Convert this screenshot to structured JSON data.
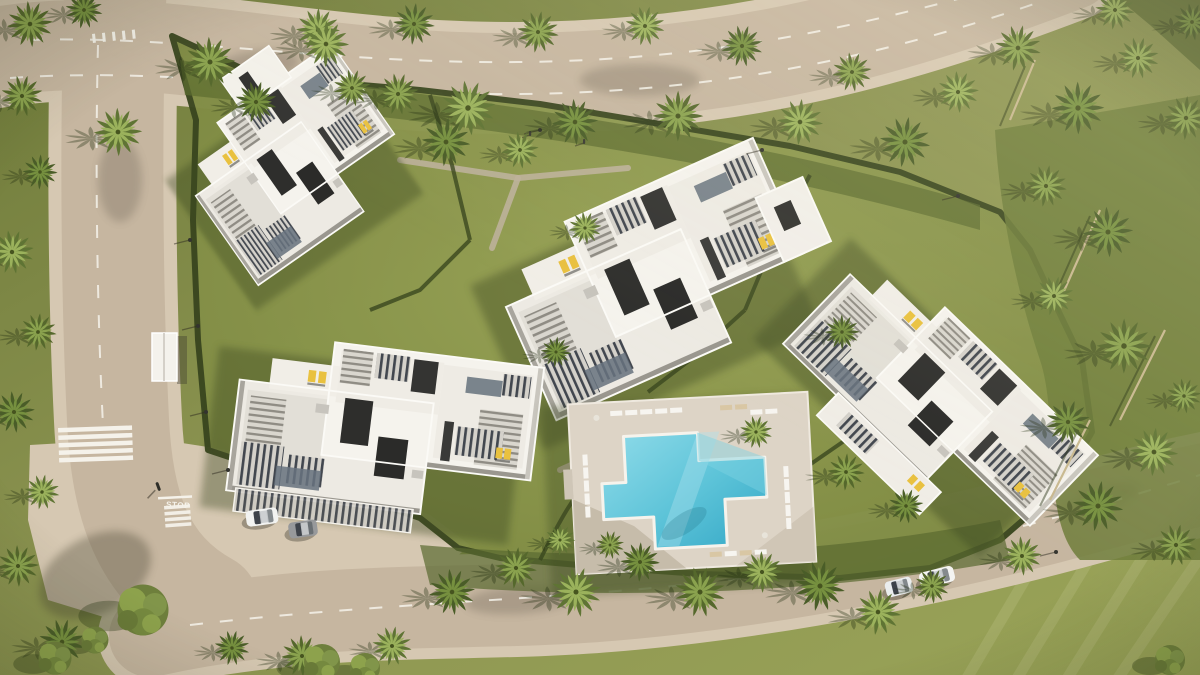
{
  "scene": {
    "description": "Aerial top-down 3D render of a white modern apartment complex: five building clusters with rooftop terraces and pergolas, central lawns, cross-shaped swimming pool with sun loungers, perimeter roads with lane markings, crosswalks, parked cars, street lamps and dense palm trees",
    "road_markings": {
      "stop_label": "STOP"
    },
    "colors": {
      "grass": "#8b9350",
      "grassDark": "#5f6c33",
      "hedge": "#3a471f",
      "road": "#c6b6a0",
      "sidewalk": "#d6c8b2",
      "marking": "#f5f2ea",
      "building": "#f2efe9",
      "deck": "#ddd4c6",
      "poolWater": "#35a8c6",
      "poolWaterLight": "#8fdbe9",
      "lounger": "#e9c13f"
    },
    "palm_variants": [
      {
        "under": "#55682c",
        "over": "#8aa24e"
      },
      {
        "under": "#4a5d28",
        "over": "#76903f"
      },
      {
        "under": "#5f7434",
        "over": "#9bb25c"
      }
    ],
    "palms": [
      [
        210,
        62,
        1.15
      ],
      [
        256,
        102,
        0.95
      ],
      [
        318,
        30,
        1.0
      ],
      [
        352,
        88,
        0.85
      ],
      [
        414,
        24,
        0.95
      ],
      [
        468,
        108,
        1.25
      ],
      [
        538,
        32,
        0.95
      ],
      [
        575,
        122,
        1.05
      ],
      [
        645,
        26,
        0.9
      ],
      [
        678,
        116,
        1.15
      ],
      [
        742,
        46,
        0.95
      ],
      [
        800,
        122,
        1.05
      ],
      [
        852,
        72,
        0.9
      ],
      [
        905,
        142,
        1.15
      ],
      [
        958,
        92,
        0.95
      ],
      [
        1018,
        48,
        1.05
      ],
      [
        1078,
        108,
        1.2
      ],
      [
        1138,
        58,
        0.95
      ],
      [
        1186,
        118,
        1.0
      ],
      [
        1192,
        22,
        0.85
      ],
      [
        1115,
        10,
        0.9
      ],
      [
        30,
        24,
        1.05
      ],
      [
        84,
        10,
        0.85
      ],
      [
        118,
        132,
        1.1
      ],
      [
        22,
        96,
        0.95
      ],
      [
        40,
        172,
        0.8
      ],
      [
        12,
        252,
        1.0
      ],
      [
        38,
        332,
        0.85
      ],
      [
        14,
        412,
        0.95
      ],
      [
        42,
        492,
        0.8
      ],
      [
        18,
        566,
        0.95
      ],
      [
        62,
        642,
        1.05
      ],
      [
        326,
        44,
        1.05
      ],
      [
        398,
        94,
        0.95
      ],
      [
        446,
        142,
        1.1
      ],
      [
        520,
        150,
        0.85
      ],
      [
        1046,
        186,
        0.95
      ],
      [
        1108,
        232,
        1.15
      ],
      [
        1054,
        296,
        0.9
      ],
      [
        1124,
        346,
        1.25
      ],
      [
        1068,
        422,
        1.0
      ],
      [
        1154,
        452,
        1.1
      ],
      [
        1184,
        396,
        0.8
      ],
      [
        1098,
        506,
        1.15
      ],
      [
        1022,
        556,
        0.9
      ],
      [
        1176,
        545,
        0.95
      ],
      [
        842,
        332,
        0.8
      ],
      [
        756,
        432,
        0.75
      ],
      [
        846,
        472,
        0.85
      ],
      [
        906,
        506,
        0.8
      ],
      [
        878,
        612,
        1.05
      ],
      [
        932,
        586,
        0.8
      ],
      [
        820,
        586,
        1.15
      ],
      [
        762,
        572,
        0.95
      ],
      [
        700,
        592,
        1.15
      ],
      [
        640,
        562,
        0.9
      ],
      [
        576,
        592,
        1.15
      ],
      [
        516,
        568,
        0.95
      ],
      [
        452,
        592,
        1.05
      ],
      [
        392,
        646,
        0.9
      ],
      [
        302,
        656,
        0.95
      ],
      [
        232,
        648,
        0.8
      ],
      [
        560,
        540,
        0.7
      ],
      [
        610,
        545,
        0.65
      ],
      [
        556,
        352,
        0.7
      ],
      [
        585,
        228,
        0.75
      ]
    ],
    "trees": [
      [
        143,
        610,
        1.7
      ],
      [
        322,
        662,
        1.2
      ],
      [
        55,
        658,
        1.1
      ],
      [
        95,
        640,
        0.9
      ],
      [
        365,
        668,
        1.0
      ],
      [
        1170,
        660,
        1.0
      ]
    ],
    "trunks": [
      [
        1060,
        300,
        1100,
        210
      ],
      [
        1120,
        420,
        1165,
        330
      ],
      [
        1050,
        500,
        1090,
        420
      ],
      [
        1010,
        120,
        1035,
        60
      ]
    ],
    "cars": [
      {
        "x": 262,
        "y": 517,
        "r": -8,
        "c": "#f2f3f1",
        "t": 1
      },
      {
        "x": 303,
        "y": 529,
        "r": -8,
        "c": "#97999b",
        "t": 0.9
      },
      {
        "x": 899,
        "y": 587,
        "r": -14,
        "c": "#eaedee",
        "t": 0.85
      },
      {
        "x": 937,
        "y": 577,
        "r": -14,
        "c": "#f4f4f2",
        "t": 1.1
      }
    ],
    "lamps": [
      [
        190,
        240
      ],
      [
        198,
        326
      ],
      [
        206,
        412
      ],
      [
        540,
        130
      ],
      [
        762,
        150
      ],
      [
        958,
        196
      ],
      [
        1056,
        552
      ],
      [
        942,
        582
      ],
      [
        228,
        470
      ]
    ],
    "figures": [
      [
        530,
        133
      ],
      [
        584,
        141
      ]
    ],
    "buildings": [
      {
        "name": "building-top-left",
        "transform": "translate(295,165) rotate(-35) scale(0.62,0.88)"
      },
      {
        "name": "building-center",
        "transform": "translate(655,280) rotate(-24) scale(0.92,1.0)"
      },
      {
        "name": "building-right",
        "transform": "translate(940,400) rotate(44) scale(0.95,0.78)"
      },
      {
        "name": "building-bottom-left",
        "transform": "translate(385,430) rotate(7) scale(0.94,0.9)"
      }
    ],
    "pool": {
      "transform": "translate(692,483) rotate(-3)"
    }
  }
}
